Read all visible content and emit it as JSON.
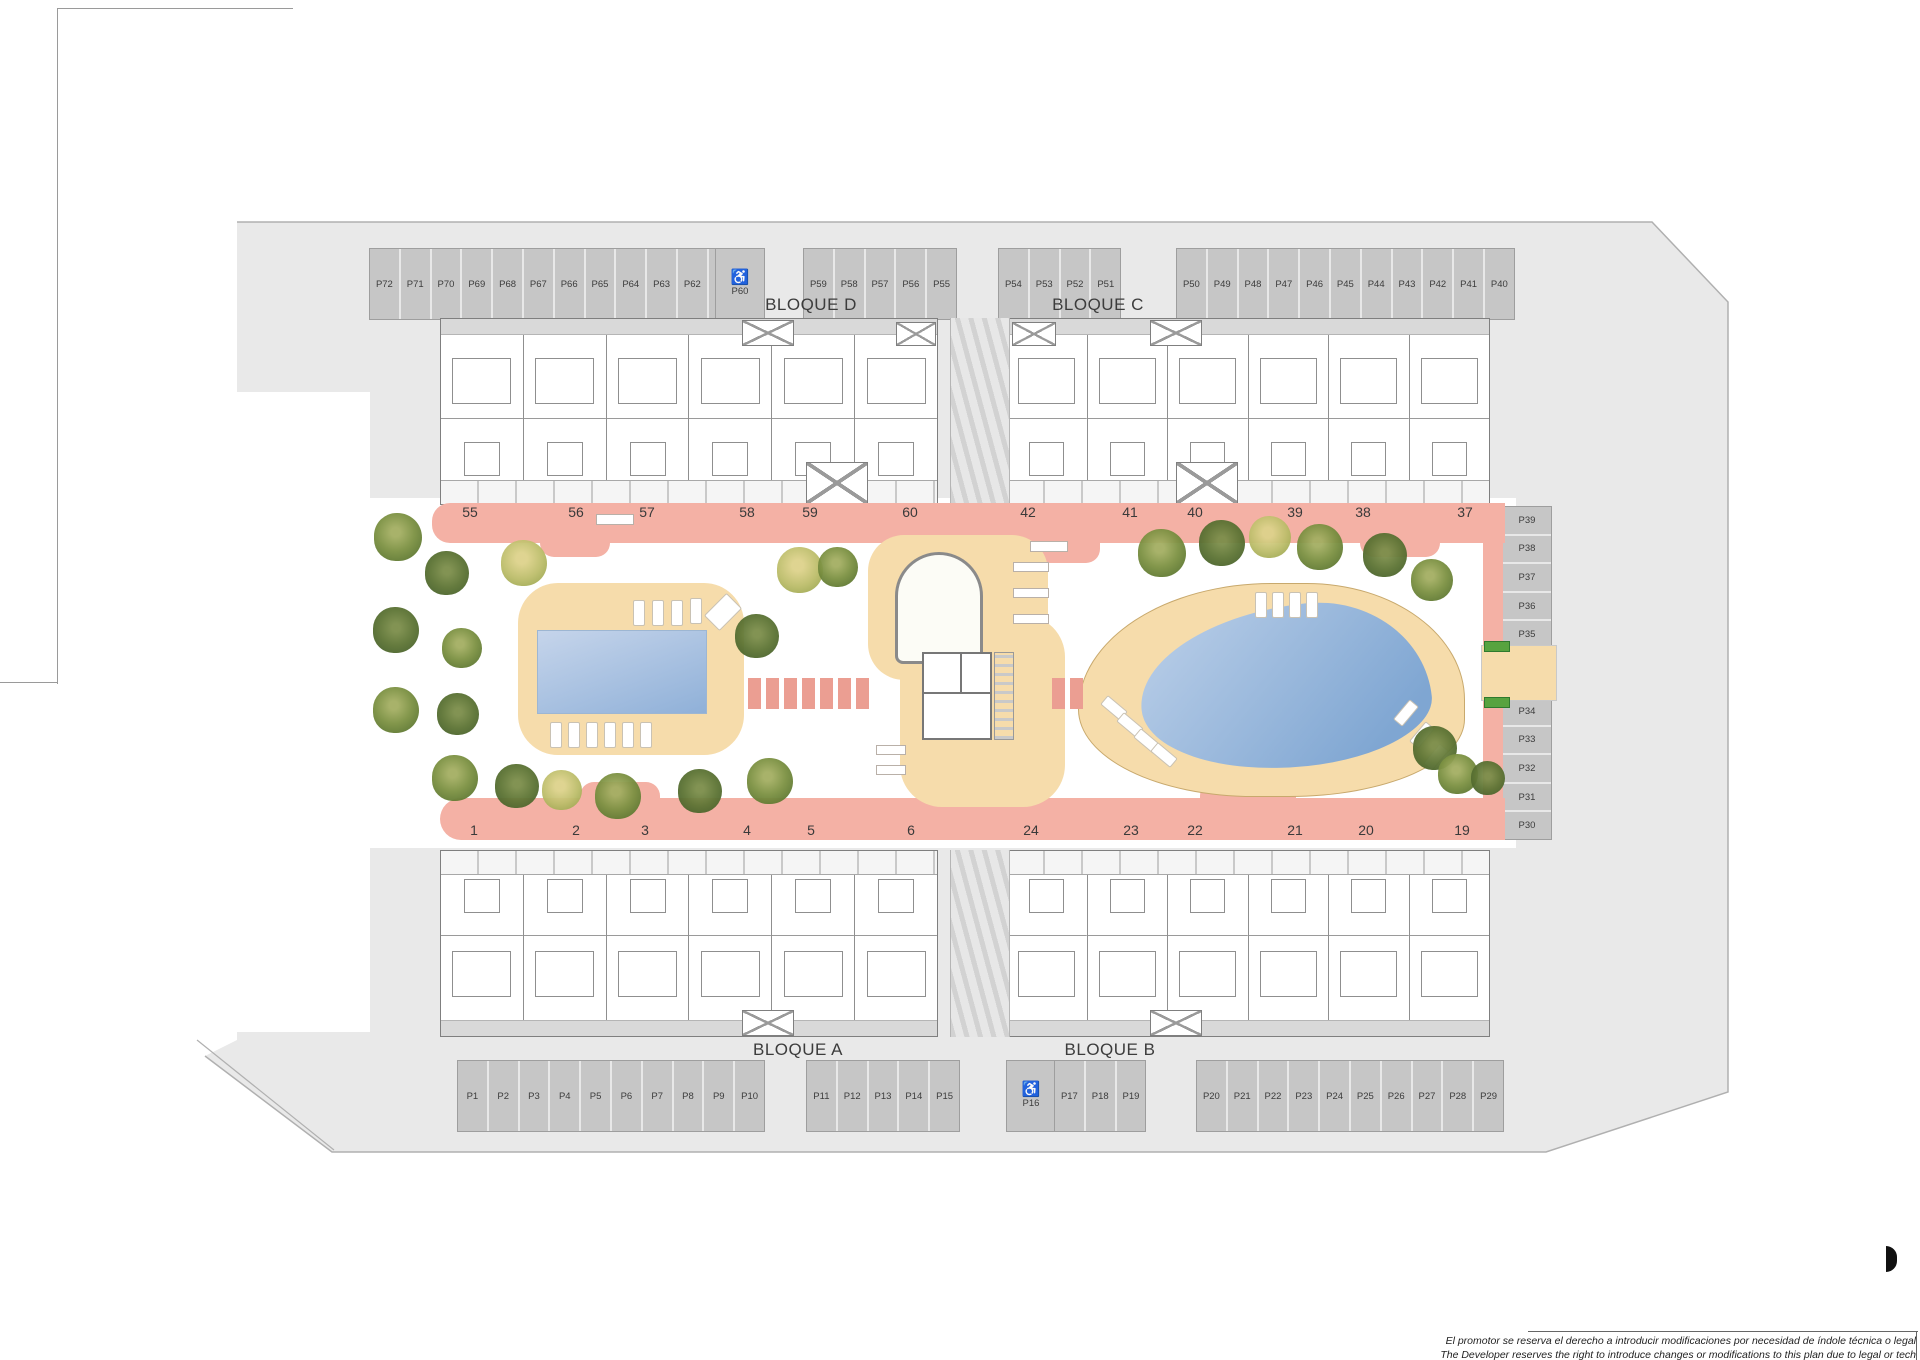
{
  "blocks": {
    "d": "BLOQUE D",
    "c": "BLOQUE C",
    "a": "BLOQUE A",
    "b": "BLOQUE B"
  },
  "icons": {
    "accessible": "♿"
  },
  "parking": {
    "top_left": [
      "P72",
      "P71",
      "P70",
      "P69",
      "P68",
      "P67",
      "P66",
      "P65",
      "P64",
      "P63",
      "P62",
      "P61"
    ],
    "top_left_accessible": "P60",
    "top_mid_a": [
      "P59",
      "P58",
      "P57",
      "P56",
      "P55"
    ],
    "top_mid_b": [
      "P54",
      "P53",
      "P52",
      "P51"
    ],
    "top_right": [
      "P50",
      "P49",
      "P48",
      "P47",
      "P46",
      "P45",
      "P44",
      "P43",
      "P42",
      "P41",
      "P40"
    ],
    "right_upper": [
      "P39",
      "P38",
      "P37",
      "P36",
      "P35"
    ],
    "right_lower": [
      "P34",
      "P33",
      "P32",
      "P31",
      "P30"
    ],
    "bottom_left": [
      "P1",
      "P2",
      "P3",
      "P4",
      "P5",
      "P6",
      "P7",
      "P8",
      "P9",
      "P10"
    ],
    "bottom_mid": [
      "P11",
      "P12",
      "P13",
      "P14",
      "P15"
    ],
    "bottom_accessible": "P16",
    "bottom_mid_b": [
      "P17",
      "P18",
      "P19"
    ],
    "bottom_right": [
      "P20",
      "P21",
      "P22",
      "P23",
      "P24",
      "P25",
      "P26",
      "P27",
      "P28",
      "P29"
    ]
  },
  "unit_numbers": {
    "top_left": [
      {
        "label": "55",
        "x": 470
      },
      {
        "label": "56",
        "x": 576
      },
      {
        "label": "57",
        "x": 647
      },
      {
        "label": "58",
        "x": 747
      },
      {
        "label": "59",
        "x": 810
      },
      {
        "label": "60",
        "x": 910
      }
    ],
    "top_right": [
      {
        "label": "42",
        "x": 1028
      },
      {
        "label": "41",
        "x": 1130
      },
      {
        "label": "40",
        "x": 1195
      },
      {
        "label": "39",
        "x": 1295
      },
      {
        "label": "38",
        "x": 1363
      },
      {
        "label": "37",
        "x": 1465
      }
    ],
    "bottom_left": [
      {
        "label": "1",
        "x": 474
      },
      {
        "label": "2",
        "x": 576
      },
      {
        "label": "3",
        "x": 645
      },
      {
        "label": "4",
        "x": 747
      },
      {
        "label": "5",
        "x": 811
      },
      {
        "label": "6",
        "x": 911
      }
    ],
    "bottom_right": [
      {
        "label": "24",
        "x": 1031
      },
      {
        "label": "23",
        "x": 1131
      },
      {
        "label": "22",
        "x": 1195
      },
      {
        "label": "21",
        "x": 1295
      },
      {
        "label": "20",
        "x": 1366
      },
      {
        "label": "19",
        "x": 1462
      }
    ]
  },
  "trees": [
    {
      "x": 374,
      "y": 513,
      "w": 48,
      "h": 48,
      "cls": "t-olive"
    },
    {
      "x": 425,
      "y": 551,
      "w": 44,
      "h": 44,
      "cls": "t-dark"
    },
    {
      "x": 501,
      "y": 540,
      "w": 46,
      "h": 46,
      "cls": "t-light"
    },
    {
      "x": 373,
      "y": 607,
      "w": 46,
      "h": 46,
      "cls": "t-dark"
    },
    {
      "x": 442,
      "y": 628,
      "w": 40,
      "h": 40,
      "cls": "t-olive"
    },
    {
      "x": 373,
      "y": 687,
      "w": 46,
      "h": 46,
      "cls": "t-olive"
    },
    {
      "x": 437,
      "y": 693,
      "w": 42,
      "h": 42,
      "cls": "t-dark"
    },
    {
      "x": 432,
      "y": 755,
      "w": 46,
      "h": 46,
      "cls": "t-olive"
    },
    {
      "x": 495,
      "y": 764,
      "w": 44,
      "h": 44,
      "cls": "t-dark"
    },
    {
      "x": 542,
      "y": 770,
      "w": 40,
      "h": 40,
      "cls": "t-light"
    },
    {
      "x": 595,
      "y": 773,
      "w": 46,
      "h": 46,
      "cls": "t-olive"
    },
    {
      "x": 678,
      "y": 769,
      "w": 44,
      "h": 44,
      "cls": "t-dark"
    },
    {
      "x": 747,
      "y": 758,
      "w": 46,
      "h": 46,
      "cls": "t-olive"
    },
    {
      "x": 735,
      "y": 614,
      "w": 44,
      "h": 44,
      "cls": "t-dark"
    },
    {
      "x": 777,
      "y": 547,
      "w": 46,
      "h": 46,
      "cls": "t-light"
    },
    {
      "x": 818,
      "y": 547,
      "w": 40,
      "h": 40,
      "cls": "t-olive"
    },
    {
      "x": 1138,
      "y": 529,
      "w": 48,
      "h": 48,
      "cls": "t-olive"
    },
    {
      "x": 1199,
      "y": 520,
      "w": 46,
      "h": 46,
      "cls": "t-dark"
    },
    {
      "x": 1249,
      "y": 516,
      "w": 42,
      "h": 42,
      "cls": "t-light"
    },
    {
      "x": 1297,
      "y": 524,
      "w": 46,
      "h": 46,
      "cls": "t-olive"
    },
    {
      "x": 1363,
      "y": 533,
      "w": 44,
      "h": 44,
      "cls": "t-dark"
    },
    {
      "x": 1411,
      "y": 559,
      "w": 42,
      "h": 42,
      "cls": "t-olive"
    },
    {
      "x": 1413,
      "y": 726,
      "w": 44,
      "h": 44,
      "cls": "t-dark"
    },
    {
      "x": 1438,
      "y": 754,
      "w": 40,
      "h": 40,
      "cls": "t-olive"
    },
    {
      "x": 1471,
      "y": 761,
      "w": 34,
      "h": 34,
      "cls": "t-dark"
    }
  ],
  "loungers": [
    {
      "x": 633,
      "y": 600
    },
    {
      "x": 652,
      "y": 600
    },
    {
      "x": 671,
      "y": 600
    },
    {
      "x": 690,
      "y": 598
    },
    {
      "x": 550,
      "y": 722
    },
    {
      "x": 568,
      "y": 722
    },
    {
      "x": 586,
      "y": 722
    },
    {
      "x": 604,
      "y": 722
    },
    {
      "x": 622,
      "y": 722
    },
    {
      "x": 640,
      "y": 722
    },
    {
      "x": 712,
      "y": 596,
      "cls": "r45 steps"
    },
    {
      "x": 1255,
      "y": 592
    },
    {
      "x": 1272,
      "y": 592
    },
    {
      "x": 1289,
      "y": 592
    },
    {
      "x": 1306,
      "y": 592
    },
    {
      "x": 1108,
      "y": 695,
      "cls": "rm50"
    },
    {
      "x": 1124,
      "y": 712,
      "cls": "rm50"
    },
    {
      "x": 1141,
      "y": 728,
      "cls": "rm50"
    },
    {
      "x": 1158,
      "y": 742,
      "cls": "rm50"
    },
    {
      "x": 1400,
      "y": 700,
      "cls": "r40"
    },
    {
      "x": 1416,
      "y": 722,
      "cls": "r40"
    },
    {
      "x": 1430,
      "y": 744,
      "cls": "r40"
    }
  ],
  "benches": [
    {
      "x": 596,
      "y": 514
    },
    {
      "x": 1030,
      "y": 541
    },
    {
      "x": 1013,
      "y": 562,
      "w": 34,
      "h": 8
    },
    {
      "x": 1013,
      "y": 588,
      "w": 34,
      "h": 8
    },
    {
      "x": 1013,
      "y": 614,
      "w": 34,
      "h": 8
    },
    {
      "x": 876,
      "y": 745,
      "w": 28,
      "h": 8
    },
    {
      "x": 876,
      "y": 765,
      "w": 28,
      "h": 8
    }
  ],
  "crosswalk_left": [
    {
      "x": 748,
      "y": 678
    },
    {
      "x": 766,
      "y": 678
    },
    {
      "x": 784,
      "y": 678
    },
    {
      "x": 802,
      "y": 678
    },
    {
      "x": 820,
      "y": 678
    },
    {
      "x": 838,
      "y": 678
    },
    {
      "x": 856,
      "y": 678
    }
  ],
  "crosswalk_right": [
    {
      "x": 1052,
      "y": 678
    },
    {
      "x": 1070,
      "y": 678
    }
  ],
  "disclaimer": {
    "es": "El promotor se reserva el derecho a introducir modificaciones por necesidad de índole técnica o legal",
    "en": "The Developer reserves the right to introduce changes or modifications to this plan due to legal or tech"
  },
  "colors": {
    "ground": "#e9e9e9",
    "stall": "#c6c6c6",
    "path_pink": "#f4b1a5",
    "crosswalk_pink": "#eb9e92",
    "deck_tan": "#f6dcab",
    "pool_blue": "#8fb0d8",
    "tree_olive": "#7c9142",
    "tree_dark": "#5d7434",
    "tree_light": "#bcbd6a",
    "gate_green": "#57a33f"
  }
}
